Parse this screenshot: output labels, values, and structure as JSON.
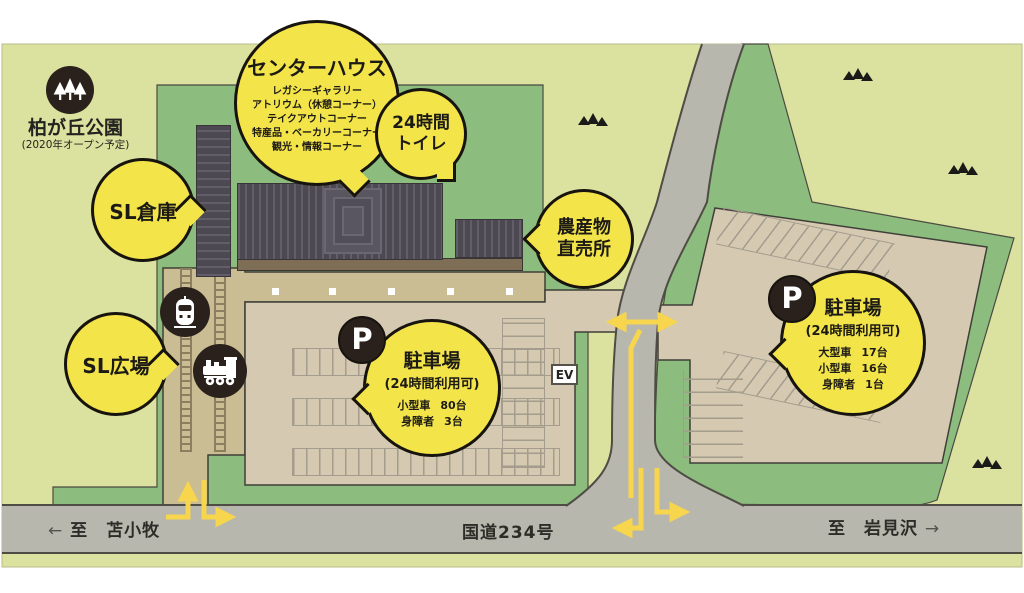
{
  "park": {
    "name": "柏が丘公園",
    "note": "(2020年オープン予定)"
  },
  "bubbles": {
    "center_house": {
      "title": "センターハウス",
      "items": [
        "レガシーギャラリー",
        "アトリウム（休憩コーナー）",
        "テイクアウトコーナー",
        "特産品・ベーカリーコーナー",
        "観光・情報コーナー"
      ]
    },
    "toilet_24h": {
      "lines": [
        "24時間",
        "トイレ"
      ]
    },
    "sl_warehouse": {
      "title": "SL倉庫"
    },
    "farm_stand": {
      "lines": [
        "農産物",
        "直売所"
      ]
    },
    "sl_plaza": {
      "title": "SL広場"
    },
    "parking_main": {
      "title": "駐車場",
      "subtitle": "(24時間利用可)",
      "capacity": [
        {
          "type": "小型車",
          "count": "80台"
        },
        {
          "type": "身障者",
          "count": "3台"
        }
      ]
    },
    "parking_east": {
      "title": "駐車場",
      "subtitle": "(24時間利用可)",
      "capacity": [
        {
          "type": "大型車",
          "count": "17台"
        },
        {
          "type": "小型車",
          "count": "16台"
        },
        {
          "type": "身障者",
          "count": "1台"
        }
      ]
    }
  },
  "road": {
    "route_name": "国道234号",
    "west_arrow": "←",
    "west_destination": "至　苫小牧",
    "east_destination": "至　岩見沢",
    "east_arrow": "→"
  },
  "signs": {
    "ev": "EV",
    "parking_symbol": "P"
  },
  "colors": {
    "bubble_yellow": "#f3e44a",
    "arrow_yellow": "#f7d64d",
    "road_gray": "#b8b7ae",
    "site_green": "#8cbd7e",
    "background_green": "#dbe19e",
    "parking_tan": "#d5cab1",
    "plaza_tan": "#cbbd93",
    "building_gray": "#56525a",
    "icon_circle": "#2b211c"
  }
}
